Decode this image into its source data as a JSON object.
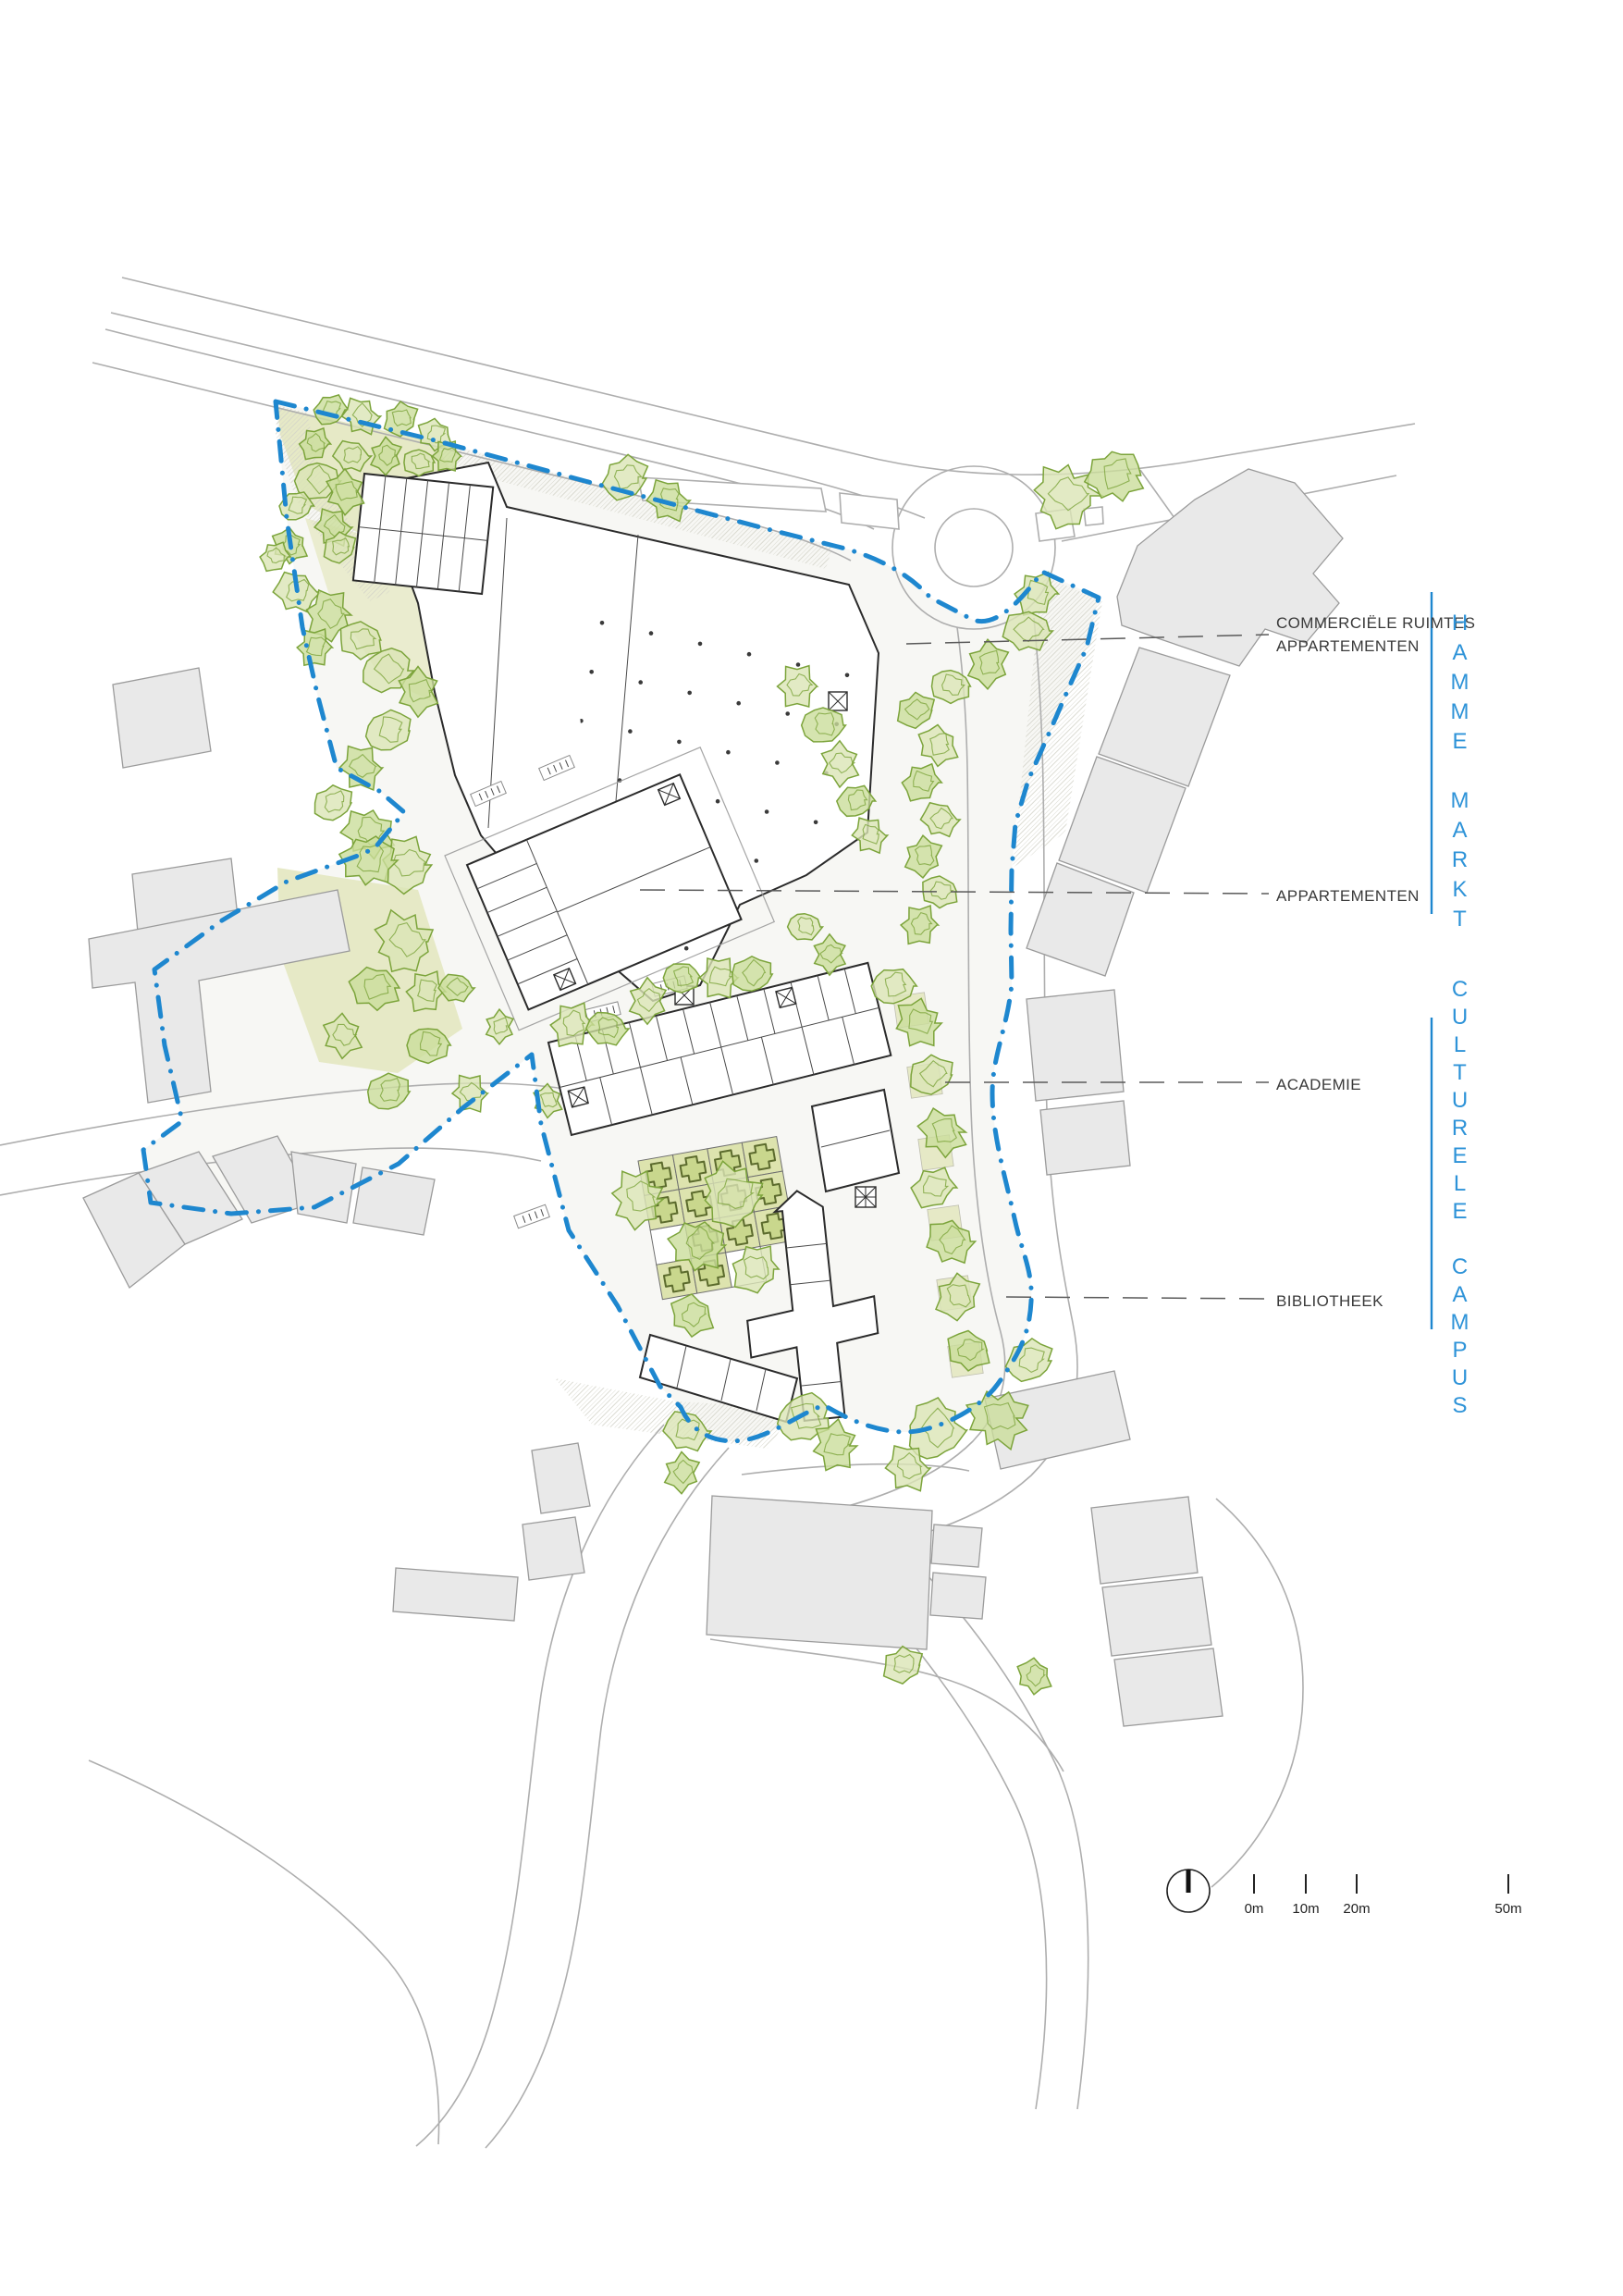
{
  "drawing": {
    "annotations": [
      {
        "lines": [
          "COMMERCIËLE RUIMTES",
          "APPARTEMENTEN"
        ]
      },
      {
        "lines": [
          "APPARTEMENTEN"
        ]
      },
      {
        "lines": [
          "ACADEMIE"
        ]
      },
      {
        "lines": [
          "BIBLIOTHEEK"
        ]
      }
    ],
    "side_titles": [
      {
        "text": "HAMME MARKT"
      },
      {
        "text": "CULTURELE CAMPUS"
      }
    ],
    "scalebar": {
      "ticks": [
        "0m",
        "10m",
        "20m",
        "50m"
      ]
    }
  },
  "colors": {
    "site_boundary_blue": "#1e87cf",
    "side_title_blue": "#2e93d8",
    "tree_stroke_green": "#7ca43b",
    "tree_fill_light": "#dbe5b5",
    "tree_fill_dark": "#cbdd9b",
    "lawn_green": "#e6e9c6",
    "garden_square_green": "#dde3ae",
    "label_ink": "#3a3a3a"
  },
  "map": {
    "trees": [
      [
        357,
        443,
        20,
        1
      ],
      [
        390,
        450,
        22,
        0
      ],
      [
        433,
        453,
        21,
        1
      ],
      [
        470,
        470,
        20,
        0
      ],
      [
        340,
        480,
        19,
        1
      ],
      [
        380,
        493,
        21,
        0
      ],
      [
        417,
        493,
        20,
        1
      ],
      [
        453,
        500,
        19,
        0
      ],
      [
        483,
        493,
        18,
        1
      ],
      [
        343,
        520,
        27,
        0
      ],
      [
        373,
        532,
        24,
        1
      ],
      [
        320,
        547,
        20,
        0
      ],
      [
        360,
        570,
        22,
        1
      ],
      [
        367,
        592,
        20,
        0
      ],
      [
        313,
        590,
        21,
        1
      ],
      [
        297,
        602,
        18,
        0
      ],
      [
        320,
        640,
        26,
        0
      ],
      [
        355,
        665,
        29,
        1
      ],
      [
        390,
        692,
        26,
        0
      ],
      [
        340,
        700,
        22,
        1
      ],
      [
        418,
        725,
        30,
        0
      ],
      [
        452,
        748,
        26,
        1
      ],
      [
        420,
        790,
        28,
        0
      ],
      [
        390,
        830,
        26,
        1
      ],
      [
        360,
        868,
        24,
        0
      ],
      [
        398,
        900,
        30,
        1
      ],
      [
        440,
        935,
        33,
        0
      ],
      [
        398,
        930,
        32,
        1
      ],
      [
        437,
        1018,
        36,
        0
      ],
      [
        405,
        1068,
        29,
        1
      ],
      [
        460,
        1072,
        24,
        0
      ],
      [
        493,
        1068,
        20,
        1
      ],
      [
        540,
        1110,
        18,
        0
      ],
      [
        463,
        1130,
        26,
        1
      ],
      [
        508,
        1182,
        22,
        0
      ],
      [
        420,
        1180,
        26,
        1
      ],
      [
        370,
        1120,
        24,
        0
      ],
      [
        676,
        517,
        28,
        0
      ],
      [
        722,
        541,
        25,
        1
      ],
      [
        1152,
        536,
        38,
        0
      ],
      [
        1205,
        514,
        33,
        1
      ],
      [
        1120,
        642,
        26,
        0
      ],
      [
        1110,
        682,
        28,
        0
      ],
      [
        1068,
        718,
        26,
        1
      ],
      [
        1028,
        742,
        24,
        0
      ],
      [
        862,
        742,
        25,
        0
      ],
      [
        890,
        784,
        26,
        1
      ],
      [
        908,
        826,
        24,
        0
      ],
      [
        925,
        866,
        22,
        1
      ],
      [
        940,
        903,
        21,
        0
      ],
      [
        990,
        768,
        23,
        1
      ],
      [
        1014,
        806,
        24,
        0
      ],
      [
        996,
        846,
        23,
        1
      ],
      [
        1016,
        886,
        22,
        0
      ],
      [
        998,
        926,
        23,
        1
      ],
      [
        1016,
        964,
        22,
        0
      ],
      [
        994,
        1000,
        23,
        1
      ],
      [
        870,
        1002,
        20,
        0
      ],
      [
        897,
        1032,
        21,
        1
      ],
      [
        966,
        1066,
        26,
        0
      ],
      [
        993,
        1106,
        28,
        1
      ],
      [
        1007,
        1162,
        27,
        0
      ],
      [
        1019,
        1224,
        28,
        1
      ],
      [
        1009,
        1284,
        26,
        0
      ],
      [
        1027,
        1342,
        28,
        1
      ],
      [
        1035,
        1402,
        27,
        0
      ],
      [
        1047,
        1460,
        26,
        1
      ],
      [
        618,
        1108,
        26,
        0
      ],
      [
        656,
        1112,
        24,
        1
      ],
      [
        700,
        1082,
        24,
        0
      ],
      [
        737,
        1057,
        22,
        1
      ],
      [
        777,
        1057,
        24,
        0
      ],
      [
        813,
        1053,
        25,
        1
      ],
      [
        592,
        1190,
        18,
        0
      ],
      [
        792,
        1292,
        38,
        0
      ],
      [
        754,
        1346,
        32,
        1
      ],
      [
        816,
        1372,
        29,
        0
      ],
      [
        748,
        1422,
        26,
        1
      ],
      [
        690,
        1296,
        33,
        0
      ],
      [
        742,
        1547,
        27,
        0
      ],
      [
        737,
        1592,
        22,
        1
      ],
      [
        869,
        1533,
        32,
        0
      ],
      [
        903,
        1563,
        28,
        1
      ],
      [
        1011,
        1546,
        37,
        0
      ],
      [
        1079,
        1533,
        35,
        1
      ],
      [
        1113,
        1471,
        28,
        0
      ],
      [
        981,
        1587,
        27,
        0
      ],
      [
        976,
        1800,
        24,
        0
      ],
      [
        1118,
        1812,
        21,
        1
      ]
    ]
  }
}
